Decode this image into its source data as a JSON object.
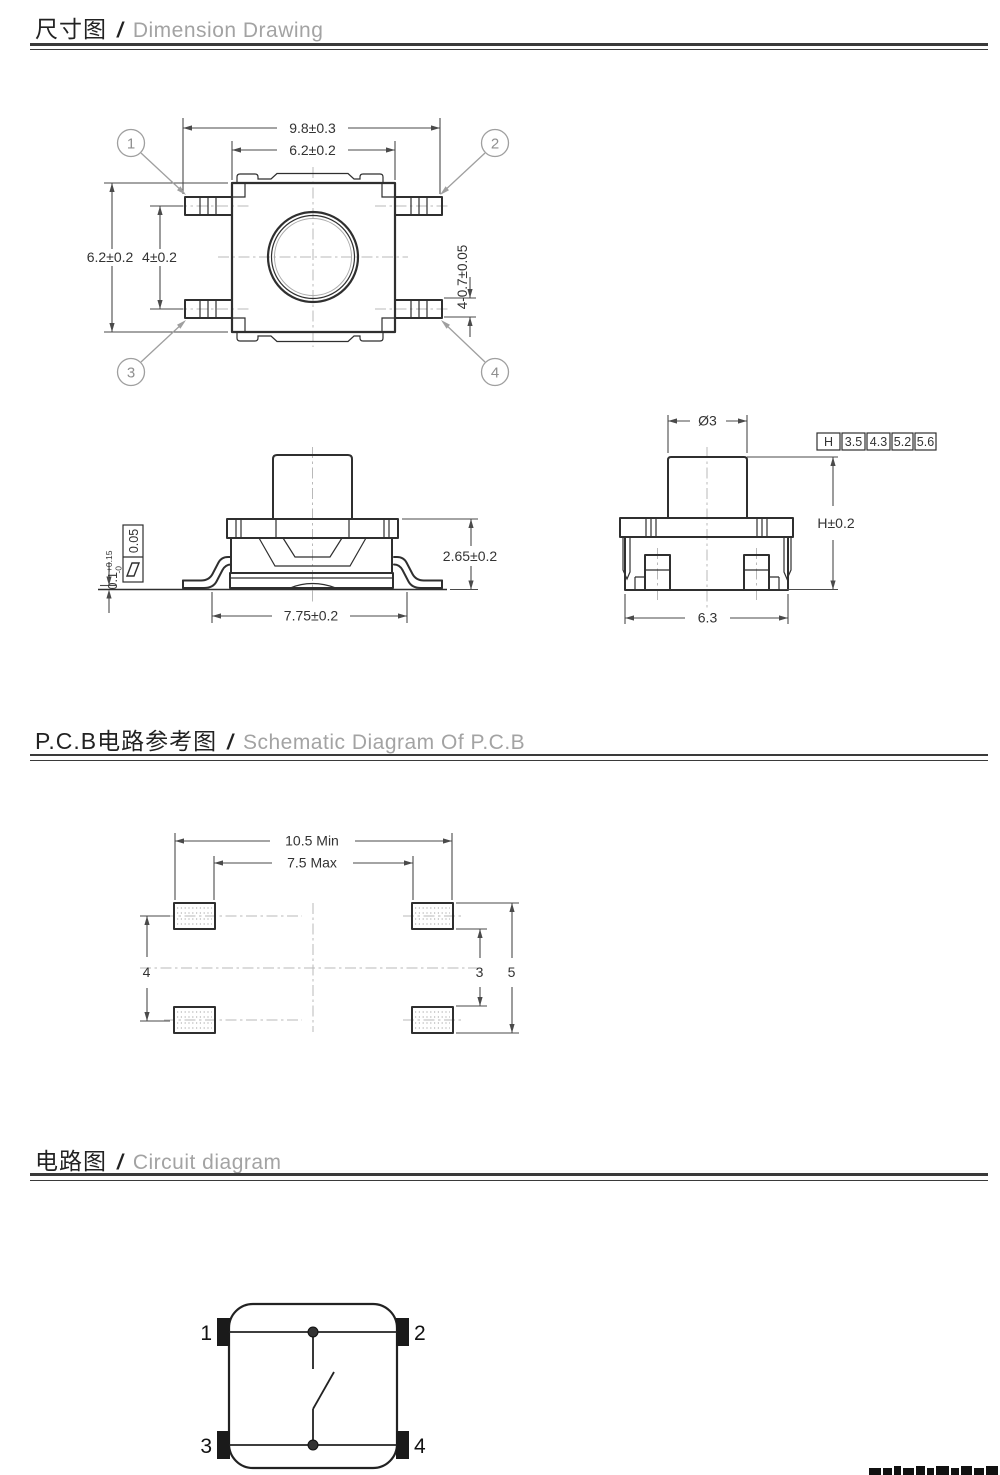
{
  "colors": {
    "ink": "#2f2f2f",
    "dim_line": "#4a4a4a",
    "gray_label": "#8f8f8f",
    "centerline": "#b9b9b9",
    "pad_black": "#1a1a1a",
    "header_en": "#a3a3a3"
  },
  "headers": {
    "dimension": {
      "zh": "尺寸图",
      "sep": "/",
      "en": "Dimension Drawing"
    },
    "pcb": {
      "zh": "P.C.B电路参考图",
      "sep": "/",
      "en": "Schematic Diagram Of P.C.B"
    },
    "circuit": {
      "zh": "电路图",
      "sep": "/",
      "en": "Circuit diagram"
    }
  },
  "top_view": {
    "dim_overall_width": "9.8±0.3",
    "dim_body_width": "6.2±0.2",
    "dim_body_height": "6.2±0.2",
    "dim_terminal_pitch": "4±0.2",
    "dim_terminal_thickness": "4-0.7±0.05",
    "pins": [
      "1",
      "2",
      "3",
      "4"
    ]
  },
  "front_view": {
    "standoff_value": "0.1",
    "standoff_plus": "+0.15",
    "standoff_minus": "-0",
    "flatness_value": "0.05",
    "dim_body_height": "2.65±0.2",
    "dim_lead_span": "7.75±0.2"
  },
  "side_view": {
    "dim_stem_diameter": "Ø3",
    "dim_height": "H±0.2",
    "dim_base_width": "6.3",
    "height_table": {
      "header": "H",
      "values": [
        "3.5",
        "4.3",
        "5.2",
        "5.6"
      ]
    }
  },
  "pcb_view": {
    "dim_pad_span_outer": "10.5 Min",
    "dim_pad_span_inner": "7.5 Max",
    "dim_pad_pitch_vertical": "4",
    "dim_pad_gap_vertical": "3",
    "dim_pad_span_vertical": "5"
  },
  "circuit_view": {
    "pins": [
      "1",
      "2",
      "3",
      "4"
    ]
  }
}
